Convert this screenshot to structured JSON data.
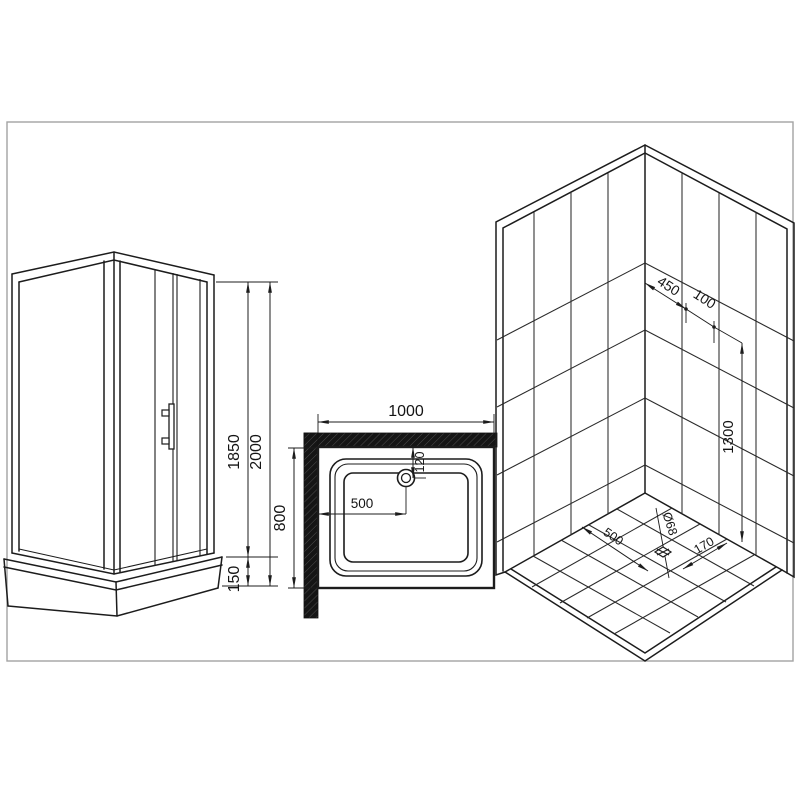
{
  "drawing": {
    "background": "#ffffff",
    "line_color": "#1c1c1c",
    "frame_color": "#a3a3a3",
    "wall_section_fill": "#151515"
  },
  "front_view": {
    "door_height": "1850",
    "total_height": "2000",
    "tray_height": "150"
  },
  "plan_view": {
    "width": "1000",
    "depth": "800",
    "drain_from_left": "500",
    "drain_from_back": "120"
  },
  "iso_view": {
    "dim_450": "450",
    "dim_100": "100",
    "dim_height": "1300",
    "floor_from_left": "500",
    "floor_from_right": "170",
    "drain_diameter": "Ø68"
  }
}
